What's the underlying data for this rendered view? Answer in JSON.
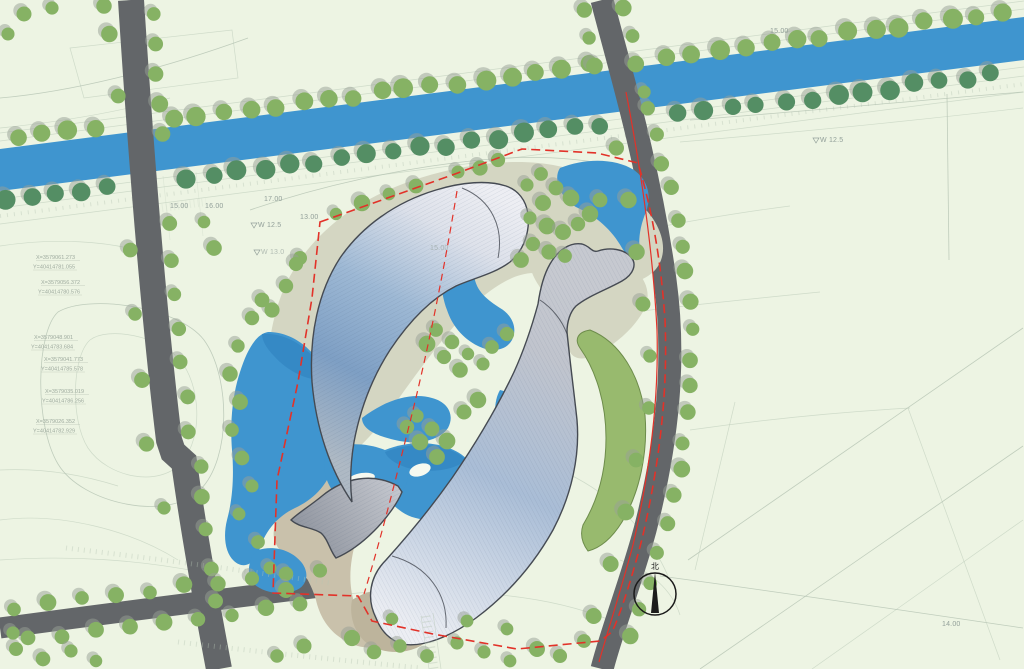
{
  "colors": {
    "background": "#edf4e3",
    "contour_line": "#b7c6b5",
    "water": "#3f95cf",
    "water_dark": "#2e7fbe",
    "tree": "#86b264",
    "tree_dark": "#548e64",
    "tree_shadow": "#98a095",
    "road": "#636669",
    "building_outline": "#454a52",
    "building_tail": "#aeb9c4",
    "building_blue": "#7e9fc4",
    "building_mid": "#9db8d4",
    "building_light": "#dde1ea",
    "building_pale": "#edeef3",
    "b_head": "#eceef3",
    "b_mid": "#a9bdd6",
    "b_gray": "#c0c4cd",
    "fin_light": "#c6c9d0",
    "fin_dark": "#8e939d",
    "olive": "#d4d6c2",
    "tan": "#c9c1ab",
    "green_band": "#98ba6e",
    "green_band_outline": "#6d8c4b",
    "boundary_red": "#e23229",
    "label_gray": "#93a09a",
    "compass_black": "#1b1b1b"
  },
  "compass": {
    "north_label": "北"
  },
  "labels": {
    "elevations": [
      {
        "text": "15.00",
        "x": 170,
        "y": 208,
        "marker": false,
        "faint": false
      },
      {
        "text": "16.00",
        "x": 205,
        "y": 208,
        "marker": false,
        "faint": false
      },
      {
        "text": "17.00",
        "x": 264,
        "y": 201,
        "marker": false,
        "faint": false
      },
      {
        "text": "W 12.5",
        "x": 258,
        "y": 227,
        "marker": true,
        "faint": false
      },
      {
        "text": "13.00",
        "x": 300,
        "y": 219,
        "marker": false,
        "faint": false
      },
      {
        "text": "W 13.0",
        "x": 261,
        "y": 254,
        "marker": true,
        "faint": true
      },
      {
        "text": "15.00",
        "x": 770,
        "y": 33,
        "marker": false,
        "faint": false
      },
      {
        "text": "W 12.5",
        "x": 820,
        "y": 142,
        "marker": true,
        "faint": false
      },
      {
        "text": "14.00",
        "x": 942,
        "y": 626,
        "marker": false,
        "faint": false
      },
      {
        "text": "15.00",
        "x": 430,
        "y": 250,
        "marker": false,
        "faint": true
      }
    ],
    "coordinates": [
      {
        "x_text": "X=3579061.273",
        "y_text": "Y=40414781.055",
        "x": 36,
        "y": 259
      },
      {
        "x_text": "X=3579056.372",
        "y_text": "Y=40414780.576",
        "x": 41,
        "y": 284
      },
      {
        "x_text": "X=3579048.901",
        "y_text": "Y=40414783.684",
        "x": 34,
        "y": 339
      },
      {
        "x_text": "X=3579041.773",
        "y_text": "Y=40414785.578",
        "x": 44,
        "y": 361
      },
      {
        "x_text": "X=3579035.019",
        "y_text": "Y=40414786.256",
        "x": 45,
        "y": 393
      },
      {
        "x_text": "X=3579026.352",
        "y_text": "Y=40414782.929",
        "x": 36,
        "y": 423
      }
    ]
  }
}
